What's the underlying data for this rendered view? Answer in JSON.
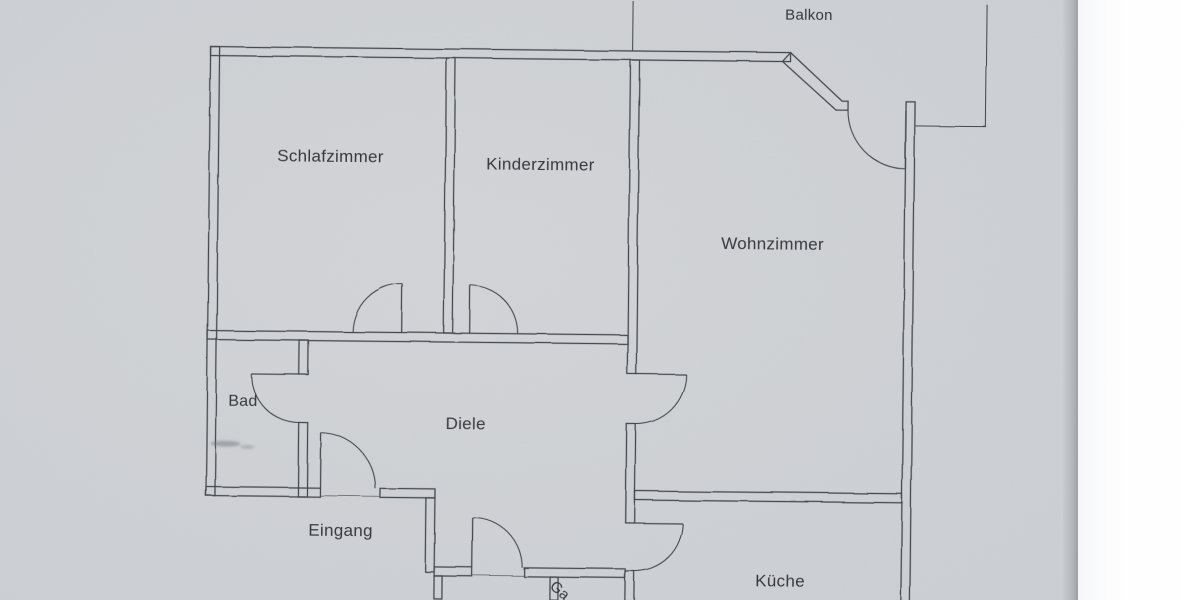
{
  "photo": {
    "description": "Photographed floor plan drawing on gray paper with white scan margin at right",
    "paper_color": "#d1d4d8",
    "ink_color": "#45484d",
    "label_color": "#37393d",
    "margin_color": "#ffffff"
  },
  "rooms": {
    "balkon": "Balkon",
    "schlafzimmer": "Schlafzimmer",
    "kinderzimmer": "Kinderzimmer",
    "wohnzimmer": "Wohnzimmer",
    "bad": "Bad",
    "diele": "Diele",
    "eingang": "Eingang",
    "kueche": "Küche",
    "garderobe_cutoff": "Ga"
  }
}
